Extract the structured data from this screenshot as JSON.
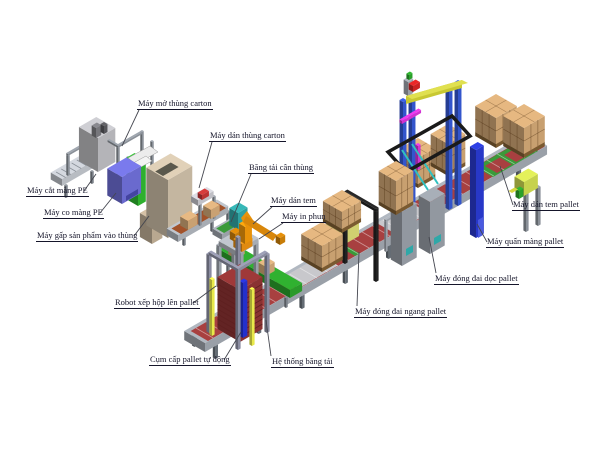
{
  "diagram": {
    "type": "isometric-factory-line-diagram",
    "background_color": "#ffffff",
    "label_text_color": "#15152a",
    "labels": [
      {
        "id": "may-mo-thung-carton",
        "text": "Máy mở thùng carton"
      },
      {
        "id": "may-dan-thung-carton",
        "text": "Máy dán thùng carton"
      },
      {
        "id": "bang-tai-can-thung",
        "text": "Băng tải cân thùng"
      },
      {
        "id": "may-dan-tem",
        "text": "Máy dán tem"
      },
      {
        "id": "may-in-phun",
        "text": "Máy in phun"
      },
      {
        "id": "may-cat-mang-pe",
        "text": "Máy cắt màng PE"
      },
      {
        "id": "may-co-mang-pe",
        "text": "Máy co màng PE"
      },
      {
        "id": "may-gap-san-pham",
        "text": "Máy gấp sản phẩm vào thùng"
      },
      {
        "id": "robot-xep-hop",
        "text": "Robot xếp hộp lên pallet"
      },
      {
        "id": "cum-cap-pallet",
        "text": "Cụm cấp pallet tự động"
      },
      {
        "id": "he-thong-bang-tai",
        "text": "Hệ thống băng tải"
      },
      {
        "id": "may-dong-dai-ngang",
        "text": "Máy đóng đai ngang pallet"
      },
      {
        "id": "may-dong-dai-doc",
        "text": "Máy đóng đai dọc pallet"
      },
      {
        "id": "may-quan-mang-pallet",
        "text": "Máy quấn màng pallet"
      },
      {
        "id": "may-dan-tem-pallet",
        "text": "Máy dán tem pallet"
      }
    ],
    "palette": {
      "robot_arm": "#e8920a",
      "carton_boxes": "#c8a070",
      "pallet_stack_red": "#8a3232",
      "conveyor_rollers_red": "#a84040",
      "conveyor_frame_gray": "#9aa0a8",
      "green_conveyor": "#2f9a3a",
      "pe_shrink_machine_purple": "#6a6ace",
      "case_packer_tan": "#c4b6a0",
      "gantry_blue": "#3355cc",
      "wrapper_blue": "#2838c8",
      "strapper_body_yellow": "#d0d070",
      "strapper_arch_black": "#222222",
      "cabinet_gray": "#9298a0",
      "labeler_yellow_green": "#c6d24e",
      "gantry_beam_yellow": "#c8c832",
      "accent_magenta": "#d033d0",
      "accent_cyan": "#30c0c0",
      "accent_red": "#cc2222"
    }
  }
}
